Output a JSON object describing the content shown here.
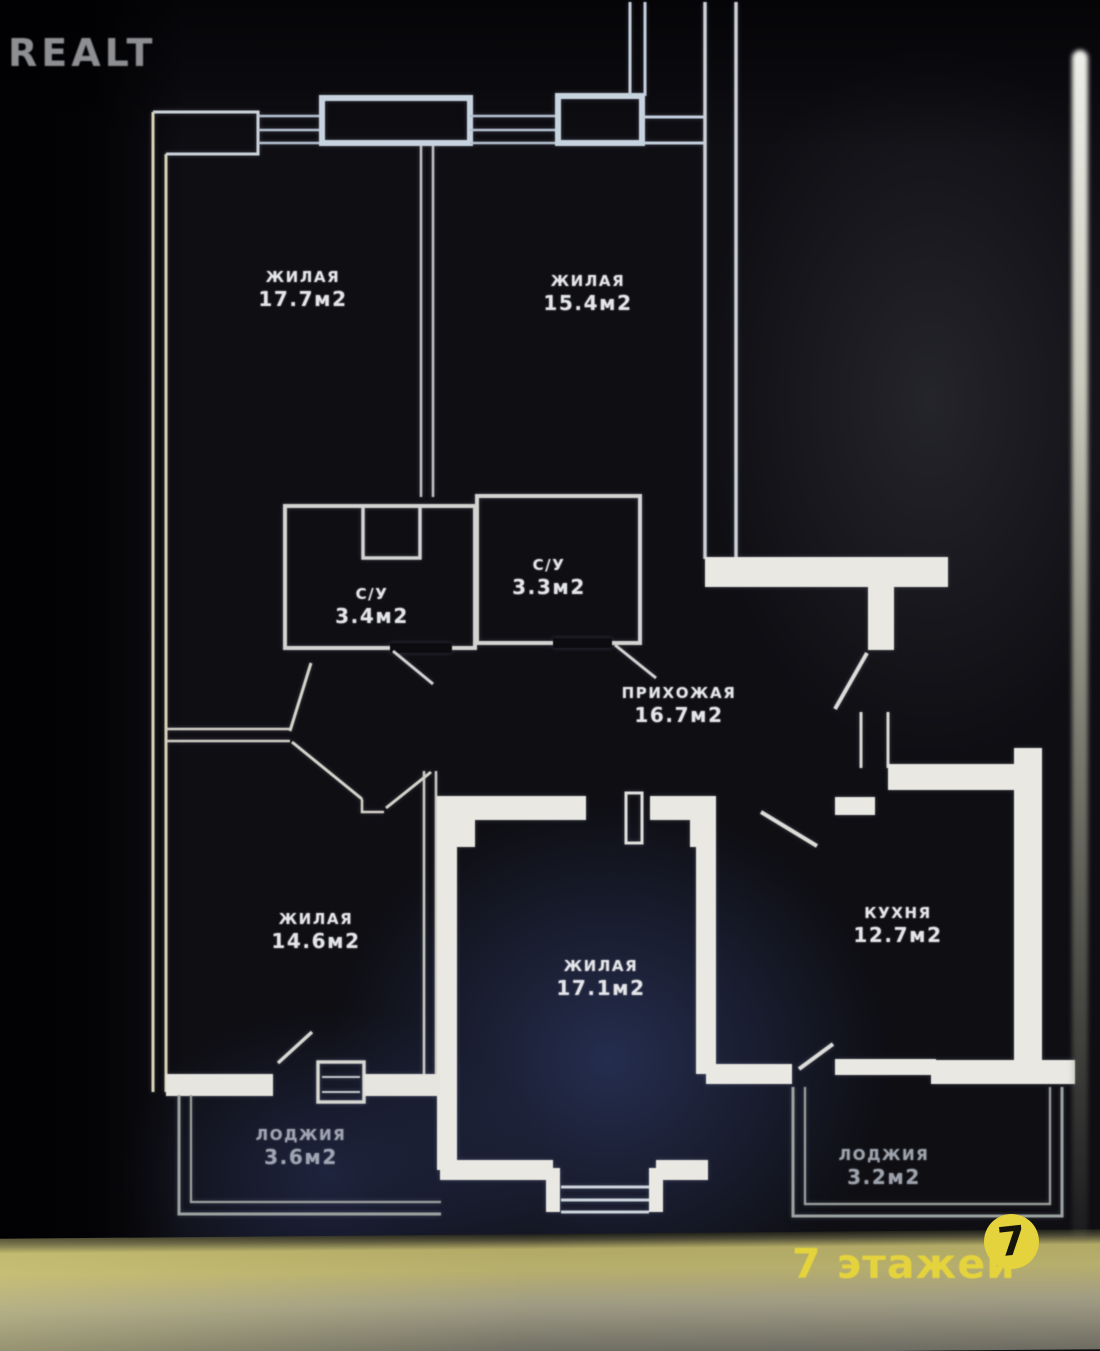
{
  "source": {
    "watermark": "Realt"
  },
  "footer": {
    "floors_text": "7 этажей",
    "floors_badge": "7"
  },
  "colors": {
    "wall_line": "#e9e8e3",
    "accent_yellow": "#e4d33c",
    "watermark_gray": "#8e8f93",
    "background": "#0e0e13"
  },
  "plan": {
    "rooms": [
      {
        "name": "жилая",
        "area": "17.7м2"
      },
      {
        "name": "жилая",
        "area": "15.4м2"
      },
      {
        "name": "с/у",
        "area": "3.4м2"
      },
      {
        "name": "с/у",
        "area": "3.3м2"
      },
      {
        "name": "прихожая",
        "area": "16.7м2"
      },
      {
        "name": "жилая",
        "area": "14.6м2"
      },
      {
        "name": "жилая",
        "area": "17.1м2"
      },
      {
        "name": "кухня",
        "area": "12.7м2"
      },
      {
        "name": "лоджия",
        "area": "3.6м2"
      },
      {
        "name": "лоджия",
        "area": "3.2м2"
      }
    ]
  }
}
